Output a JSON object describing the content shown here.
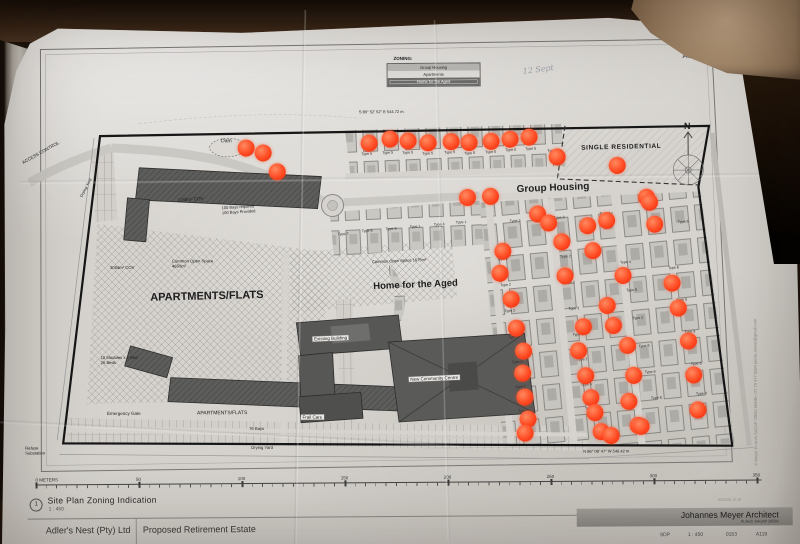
{
  "photo": {
    "desk_color": "#1c120b",
    "paper_color": "#d6d3ce",
    "marker_color": "#ff4a22"
  },
  "sheet": {
    "size_label": "A1",
    "handwritten_note": "12 Sept",
    "side_note": "© Meyer  Pr.Arch SACAP 20560   Mobile +27 79 477 8584   jannie.meyer@gmail.com"
  },
  "legend": {
    "title": "ZONING:",
    "items": [
      "Group Housing",
      "Apartments",
      "Home for the Aged"
    ]
  },
  "scalebar": {
    "labels": [
      "0 METERS",
      "50",
      "100",
      "150",
      "200",
      "250",
      "300",
      "350"
    ]
  },
  "titleblock": {
    "drawing_number": "1",
    "drawing_title": "Site Plan Zoning Indication",
    "drawing_scale": "1 : 450",
    "client": "Adler's Nest (Pty) Ltd",
    "project": "Proposed Retirement Estate",
    "architect": "Johannes Meyer Architect",
    "architect_sub": "Pr.Arch SACAP 20560",
    "stamp": "20/03/08 13:18",
    "doc_type": "SDP",
    "doc_scale": "1 : 450",
    "doc_number": "0153",
    "sheet_ref": "A119"
  },
  "plan": {
    "labels": [
      {
        "text": "Dam",
        "x": 222,
        "y": 138,
        "s": 5
      },
      {
        "text": "ACCESS CONTROL",
        "x": 22,
        "y": 158,
        "s": 4.5,
        "r": -29
      },
      {
        "text": "Drying Yard",
        "x": 80,
        "y": 194,
        "s": 4,
        "r": -62
      },
      {
        "text": "1180m² COV",
        "x": 178,
        "y": 196,
        "s": 4.5,
        "r": -3
      },
      {
        "text": "100 Bays required\n100 Bays Provided",
        "x": 222,
        "y": 205,
        "s": 4,
        "r": -3
      },
      {
        "text": "Common Open Space\n4650m²",
        "x": 172,
        "y": 258,
        "s": 4.2
      },
      {
        "text": "3084m² COV",
        "x": 110,
        "y": 264,
        "s": 4.2
      },
      {
        "text": "APARTMENTS/FLATS",
        "x": 150,
        "y": 290,
        "s": 11,
        "b": 1,
        "r": -1
      },
      {
        "text": "18 Modules x 2 Bed\n26 Beds",
        "x": 100,
        "y": 354,
        "s": 4.2
      },
      {
        "text": "APARTMENTS/FLATS",
        "x": 196,
        "y": 410,
        "s": 5
      },
      {
        "text": "Emergency Gate",
        "x": 106,
        "y": 409,
        "s": 4.5
      },
      {
        "text": "76 Bays",
        "x": 248,
        "y": 426,
        "s": 4.2
      },
      {
        "text": "Refuse\nSubstation",
        "x": 24,
        "y": 444,
        "s": 4.2
      },
      {
        "text": "Drying Yard",
        "x": 250,
        "y": 445,
        "s": 4.2
      },
      {
        "text": "Home for the Aged",
        "x": 373,
        "y": 281,
        "s": 9.5,
        "b": 1,
        "r": -2
      },
      {
        "text": "Common Open Space 1675m²",
        "x": 372,
        "y": 260,
        "s": 4,
        "r": -2
      },
      {
        "text": "Existing Building",
        "x": 312,
        "y": 336,
        "s": 4.5,
        "chip": 1,
        "r": -2
      },
      {
        "text": "New Community Centre",
        "x": 408,
        "y": 377,
        "s": 4.5,
        "chip": 1,
        "r": -2
      },
      {
        "text": "Frail Care",
        "x": 300,
        "y": 414,
        "s": 4.5,
        "chip": 1
      },
      {
        "text": "Group Housing",
        "x": 517,
        "y": 185,
        "s": 10,
        "b": 1,
        "r": -2
      },
      {
        "text": "SINGLE RESIDENTIAL",
        "x": 582,
        "y": 146,
        "s": 6.5,
        "b": 1,
        "r": -1,
        "ls": 0.6
      },
      {
        "text": "S 89° 52' 52\" E    544.72 m",
        "x": 360,
        "y": 110,
        "s": 4
      },
      {
        "text": "N 86° 08' 47\" W    546.42 m",
        "x": 582,
        "y": 451,
        "s": 4
      },
      {
        "text": "N",
        "x": 685,
        "y": 123,
        "s": 9,
        "b": 1
      }
    ],
    "unit_labels": [
      {
        "t": "Type 5",
        "x": 362,
        "y": 152
      },
      {
        "t": "Type 5",
        "x": 383,
        "y": 151
      },
      {
        "t": "Type 5",
        "x": 403,
        "y": 151
      },
      {
        "t": "Type 5",
        "x": 423,
        "y": 152
      },
      {
        "t": "Type 5",
        "x": 445,
        "y": 151
      },
      {
        "t": "Type 5",
        "x": 465,
        "y": 152
      },
      {
        "t": "Type 5",
        "x": 486,
        "y": 151
      },
      {
        "t": "Type 5",
        "x": 506,
        "y": 149
      },
      {
        "t": "Type 5",
        "x": 526,
        "y": 148
      },
      {
        "t": "Type 6",
        "x": 548,
        "y": 150
      },
      {
        "t": "Type 7",
        "x": 338,
        "y": 232
      },
      {
        "t": "Type 6",
        "x": 362,
        "y": 229
      },
      {
        "t": "Type 6",
        "x": 386,
        "y": 227
      },
      {
        "t": "Type 1",
        "x": 410,
        "y": 225
      },
      {
        "t": "Type 4",
        "x": 434,
        "y": 223
      },
      {
        "t": "Type 1",
        "x": 456,
        "y": 221
      },
      {
        "t": "Type 3",
        "x": 510,
        "y": 220
      },
      {
        "t": "Type 3",
        "x": 554,
        "y": 217
      },
      {
        "t": "Type 4",
        "x": 600,
        "y": 213
      },
      {
        "t": "Type 4",
        "x": 644,
        "y": 209
      },
      {
        "t": "Type 6",
        "x": 678,
        "y": 222
      },
      {
        "t": "Type 2",
        "x": 497,
        "y": 258
      },
      {
        "t": "Type 2",
        "x": 500,
        "y": 284
      },
      {
        "t": "Type 2",
        "x": 504,
        "y": 310
      },
      {
        "t": "Type 2",
        "x": 508,
        "y": 336
      },
      {
        "t": "Type 8",
        "x": 511,
        "y": 361
      },
      {
        "t": "Type 2",
        "x": 514,
        "y": 386
      },
      {
        "t": "Type 2",
        "x": 517,
        "y": 410
      },
      {
        "t": "Type 2",
        "x": 520,
        "y": 432
      },
      {
        "t": "Type 2",
        "x": 560,
        "y": 256
      },
      {
        "t": "Type 2",
        "x": 564,
        "y": 282
      },
      {
        "t": "Type 3",
        "x": 568,
        "y": 308
      },
      {
        "t": "Type 1",
        "x": 572,
        "y": 334
      },
      {
        "t": "Type 2",
        "x": 576,
        "y": 359
      },
      {
        "t": "Type 3",
        "x": 580,
        "y": 384
      },
      {
        "t": "Type 2",
        "x": 584,
        "y": 408
      },
      {
        "t": "Type 4",
        "x": 620,
        "y": 262
      },
      {
        "t": "Type 6",
        "x": 626,
        "y": 290
      },
      {
        "t": "Type 2",
        "x": 632,
        "y": 318
      },
      {
        "t": "Type 9",
        "x": 638,
        "y": 346
      },
      {
        "t": "Type 8",
        "x": 644,
        "y": 372
      },
      {
        "t": "Type 6",
        "x": 650,
        "y": 398
      },
      {
        "t": "Type 6",
        "x": 668,
        "y": 268
      },
      {
        "t": "Type 5",
        "x": 676,
        "y": 300
      },
      {
        "t": "Type 9",
        "x": 684,
        "y": 332
      },
      {
        "t": "Type 6",
        "x": 690,
        "y": 364
      },
      {
        "t": "Type 9",
        "x": 695,
        "y": 394
      }
    ],
    "dots": [
      [
        247,
        147
      ],
      [
        264,
        152
      ],
      [
        278,
        171
      ],
      [
        370,
        143
      ],
      [
        391,
        139
      ],
      [
        409,
        141
      ],
      [
        429,
        143
      ],
      [
        452,
        142
      ],
      [
        470,
        143
      ],
      [
        492,
        142
      ],
      [
        511,
        140
      ],
      [
        530,
        138
      ],
      [
        558,
        158
      ],
      [
        618,
        167
      ],
      [
        647,
        199
      ],
      [
        468,
        198
      ],
      [
        491,
        197
      ],
      [
        538,
        215
      ],
      [
        549,
        224
      ],
      [
        588,
        227
      ],
      [
        607,
        222
      ],
      [
        650,
        204
      ],
      [
        655,
        226
      ],
      [
        503,
        252
      ],
      [
        500,
        274
      ],
      [
        511,
        300
      ],
      [
        516,
        329
      ],
      [
        523,
        352
      ],
      [
        522,
        374
      ],
      [
        524,
        398
      ],
      [
        527,
        420
      ],
      [
        524,
        434
      ],
      [
        562,
        243
      ],
      [
        593,
        252
      ],
      [
        565,
        277
      ],
      [
        583,
        328
      ],
      [
        578,
        352
      ],
      [
        585,
        377
      ],
      [
        590,
        399
      ],
      [
        594,
        414
      ],
      [
        600,
        433
      ],
      [
        610,
        437
      ],
      [
        623,
        277
      ],
      [
        672,
        285
      ],
      [
        678,
        310
      ],
      [
        607,
        307
      ],
      [
        613,
        327
      ],
      [
        627,
        347
      ],
      [
        633,
        377
      ],
      [
        628,
        403
      ],
      [
        637,
        427
      ],
      [
        688,
        343
      ],
      [
        693,
        377
      ],
      [
        697,
        412
      ],
      [
        640,
        428
      ]
    ]
  }
}
